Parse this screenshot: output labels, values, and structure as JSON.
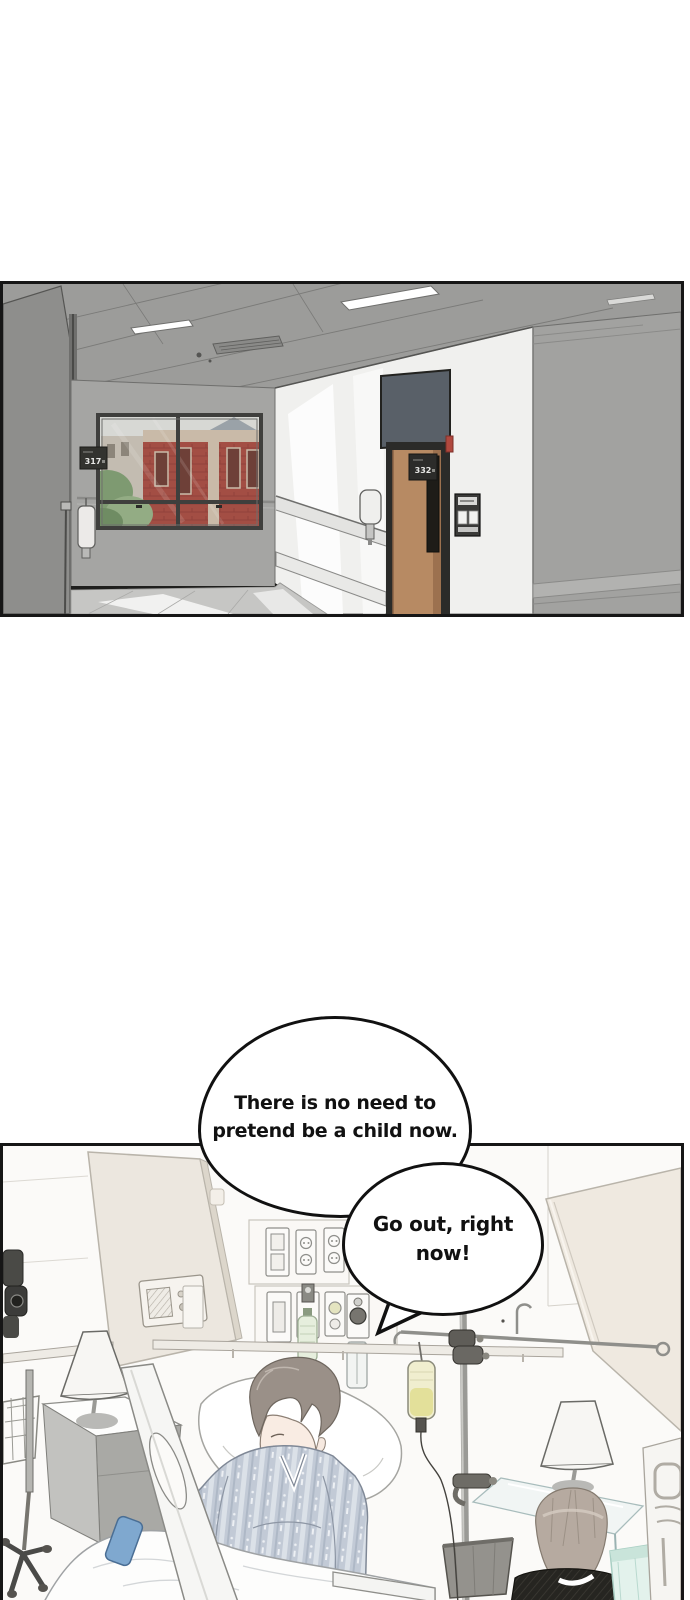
{
  "scene": {
    "hallway": {
      "room_sign_left": "317",
      "room_sign_door": "332"
    },
    "dialogue": {
      "bubble1_line1": "There is no need to",
      "bubble1_line2": "pretend be a child now.",
      "bubble2_line1": "Go out, right",
      "bubble2_line2": "now!"
    },
    "colors": {
      "panel_outline": "#161616",
      "ceiling_gray": "#9c9c9a",
      "wall_gray": "#a5a5a3",
      "wall_white": "#f0f0ee",
      "door_wood": "#b78a63",
      "floor_gray": "#c6c6c4",
      "brick_red": "#a34e44",
      "ward_wall": "#fbfaf8",
      "screen_beige": "#ece7df",
      "gown_blue_gray": "#c2cad6",
      "bed_control_blue": "#7fa8cf",
      "bin_teal": "#e3f2ec"
    }
  }
}
